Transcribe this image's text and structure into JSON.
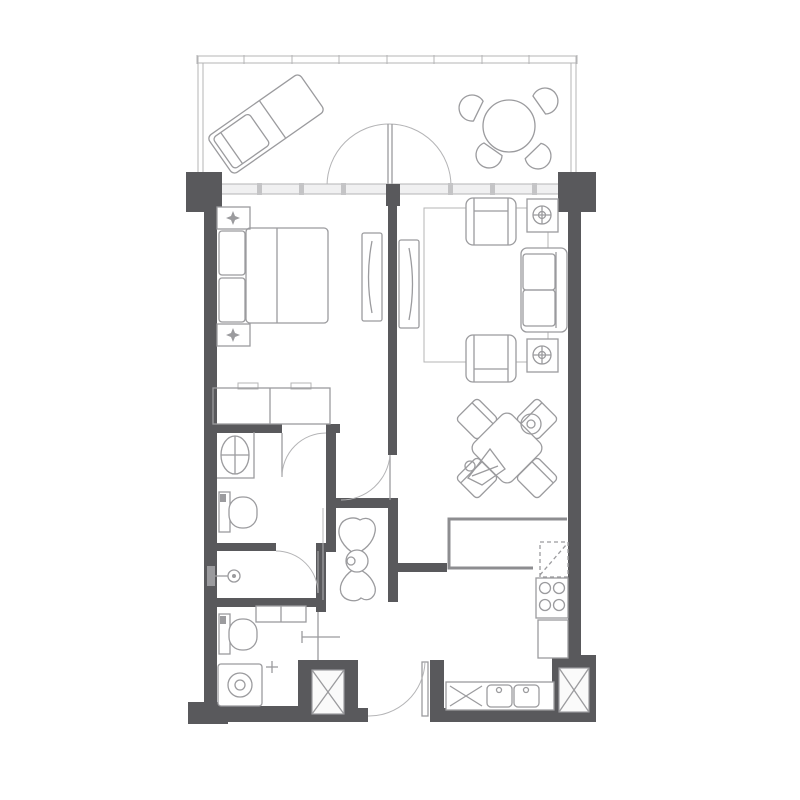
{
  "meta": {
    "kind": "architectural-floor-plan",
    "description": "one-bedroom apartment unit plan with balcony",
    "canvas": {
      "width": 800,
      "height": 800
    }
  },
  "palette": {
    "bg": "#ffffff",
    "wall": "#59595c",
    "furn": "#9b9b9e",
    "lt": "#b4b4b6",
    "counter": "#8d8d90",
    "glass": "#f0f0f1",
    "mullion": "#c4c4c6",
    "panel": "#fafafa"
  },
  "legend": {
    "rooms": [
      "balcony",
      "bedroom",
      "living-dining-room",
      "bathroom",
      "shower-room",
      "toilet-laundry-room",
      "kitchen",
      "entry-foyer"
    ],
    "fixtures": [
      "chaise-lounge",
      "patio-table",
      "patio-chairs",
      "french-doors",
      "double-bed",
      "nightstands",
      "wardrobe-dresser",
      "tv-panels",
      "armchairs",
      "sofa",
      "side-table-lamps",
      "area-rug",
      "dining-table",
      "dining-chairs",
      "vanity-sink",
      "toilets",
      "shower-head",
      "washing-machine",
      "kitchen-counter",
      "cooktop",
      "double-sink",
      "upper-cabinets-dashed",
      "service-shafts",
      "entry-door"
    ]
  }
}
